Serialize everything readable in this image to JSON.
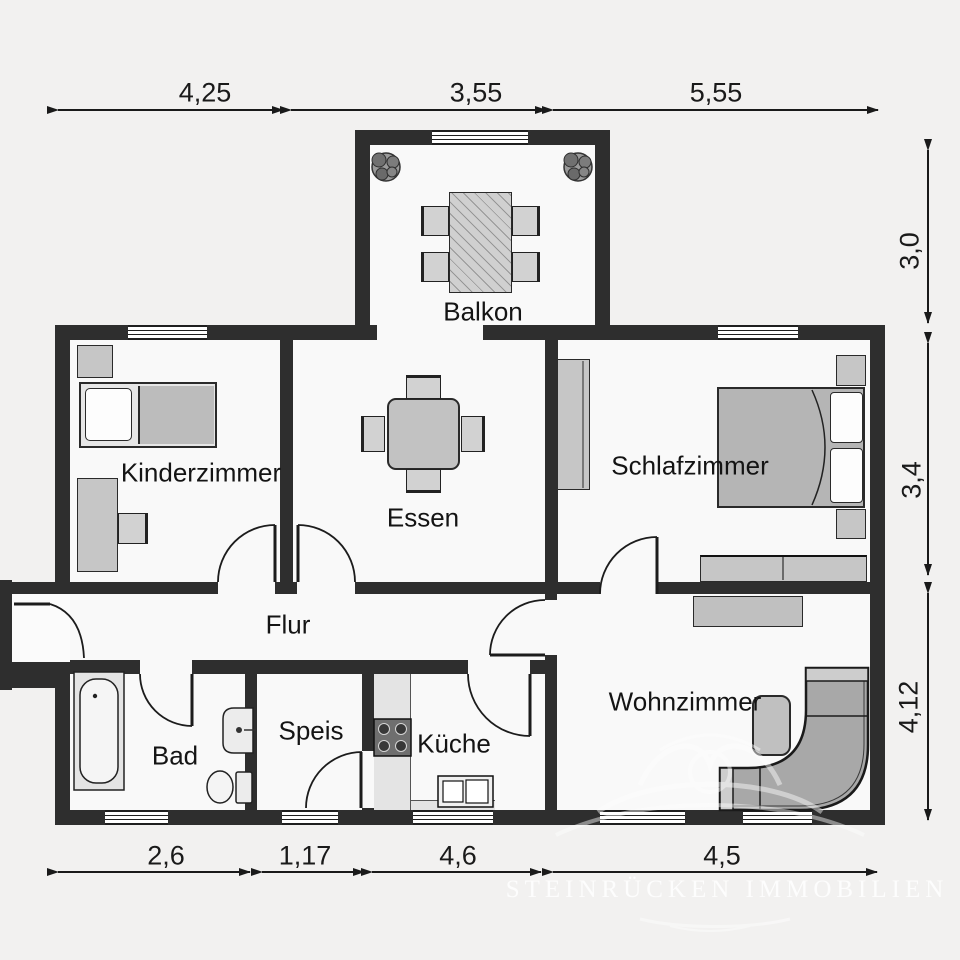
{
  "rooms": {
    "kinderzimmer": {
      "label": "Kinderzimmer"
    },
    "essen": {
      "label": "Essen"
    },
    "schlafzimmer": {
      "label": "Schlafzimmer"
    },
    "balkon": {
      "label": "Balkon"
    },
    "flur": {
      "label": "Flur"
    },
    "bad": {
      "label": "Bad"
    },
    "speis": {
      "label": "Speis"
    },
    "kueche": {
      "label": "Küche"
    },
    "wohnzimmer": {
      "label": "Wohnzimmer"
    }
  },
  "dimensions": {
    "top": {
      "d1": "4,25",
      "d2": "3,55",
      "d3": "5,55"
    },
    "right": {
      "d1": "3,0",
      "d2": "3,4",
      "d3": "4,12"
    },
    "bottom": {
      "d1": "2,6",
      "d2": "1,17",
      "d3": "4,6",
      "d4": "4,5"
    }
  },
  "watermark": {
    "text": "STEINRÜCKEN IMMOBILIEN"
  },
  "colors": {
    "wall": "#2e2e2e",
    "floor": "#f9f9f9",
    "background": "#f2f1f0",
    "furniture_light": "#c6c6c6",
    "furniture_mid": "#a8a8a8",
    "line": "#1a1a1a",
    "watermark": "#ffffff"
  }
}
